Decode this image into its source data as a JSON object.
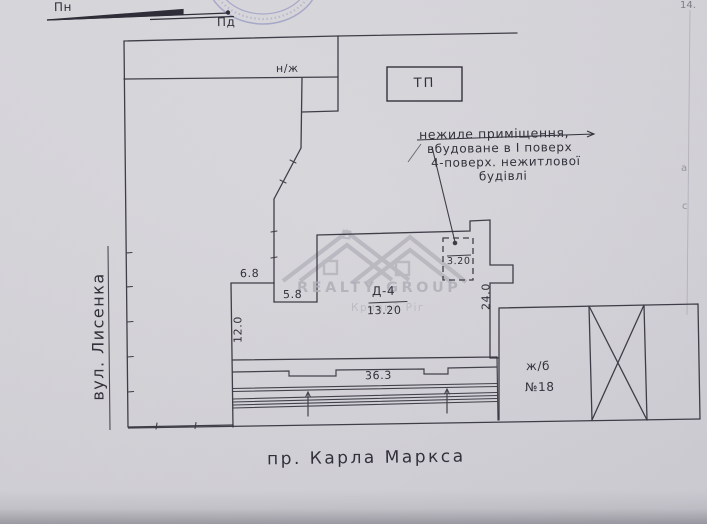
{
  "page": {
    "number": "14."
  },
  "compass": {
    "north": "Пн",
    "south": "Пд"
  },
  "plan": {
    "transformer_label": "ТП",
    "top_strip_label": "н/ж",
    "building_code": "Д-4",
    "right_building": {
      "type": "ж/б",
      "number": "№18"
    }
  },
  "streets": {
    "left": "вул. Лисенка",
    "bottom": "пр. Карла Маркса"
  },
  "annotation": {
    "line1": "нежиле приміщення,",
    "line2": "вбудоване в І поверх",
    "line3": "4-поверх. нежитлової",
    "line4": "будівлі"
  },
  "dimensions": {
    "courtyard_top": "6.8",
    "courtyard_step": "5.8",
    "courtyard_left": "12.0",
    "building_width": "13.20",
    "building_right": "24.0",
    "frontage": "36.3",
    "inset_room": "3.20"
  },
  "watermark": {
    "brand": "REALTY GROUP",
    "city": "Кривий Ріг"
  },
  "edge_artifacts": {
    "mark1": "а",
    "mark2": "с"
  },
  "colors": {
    "paper": "#d6d5da",
    "ink": "#2f2e38",
    "stamp_ink": "#8084b8",
    "watermark": "#b2b1b9"
  }
}
